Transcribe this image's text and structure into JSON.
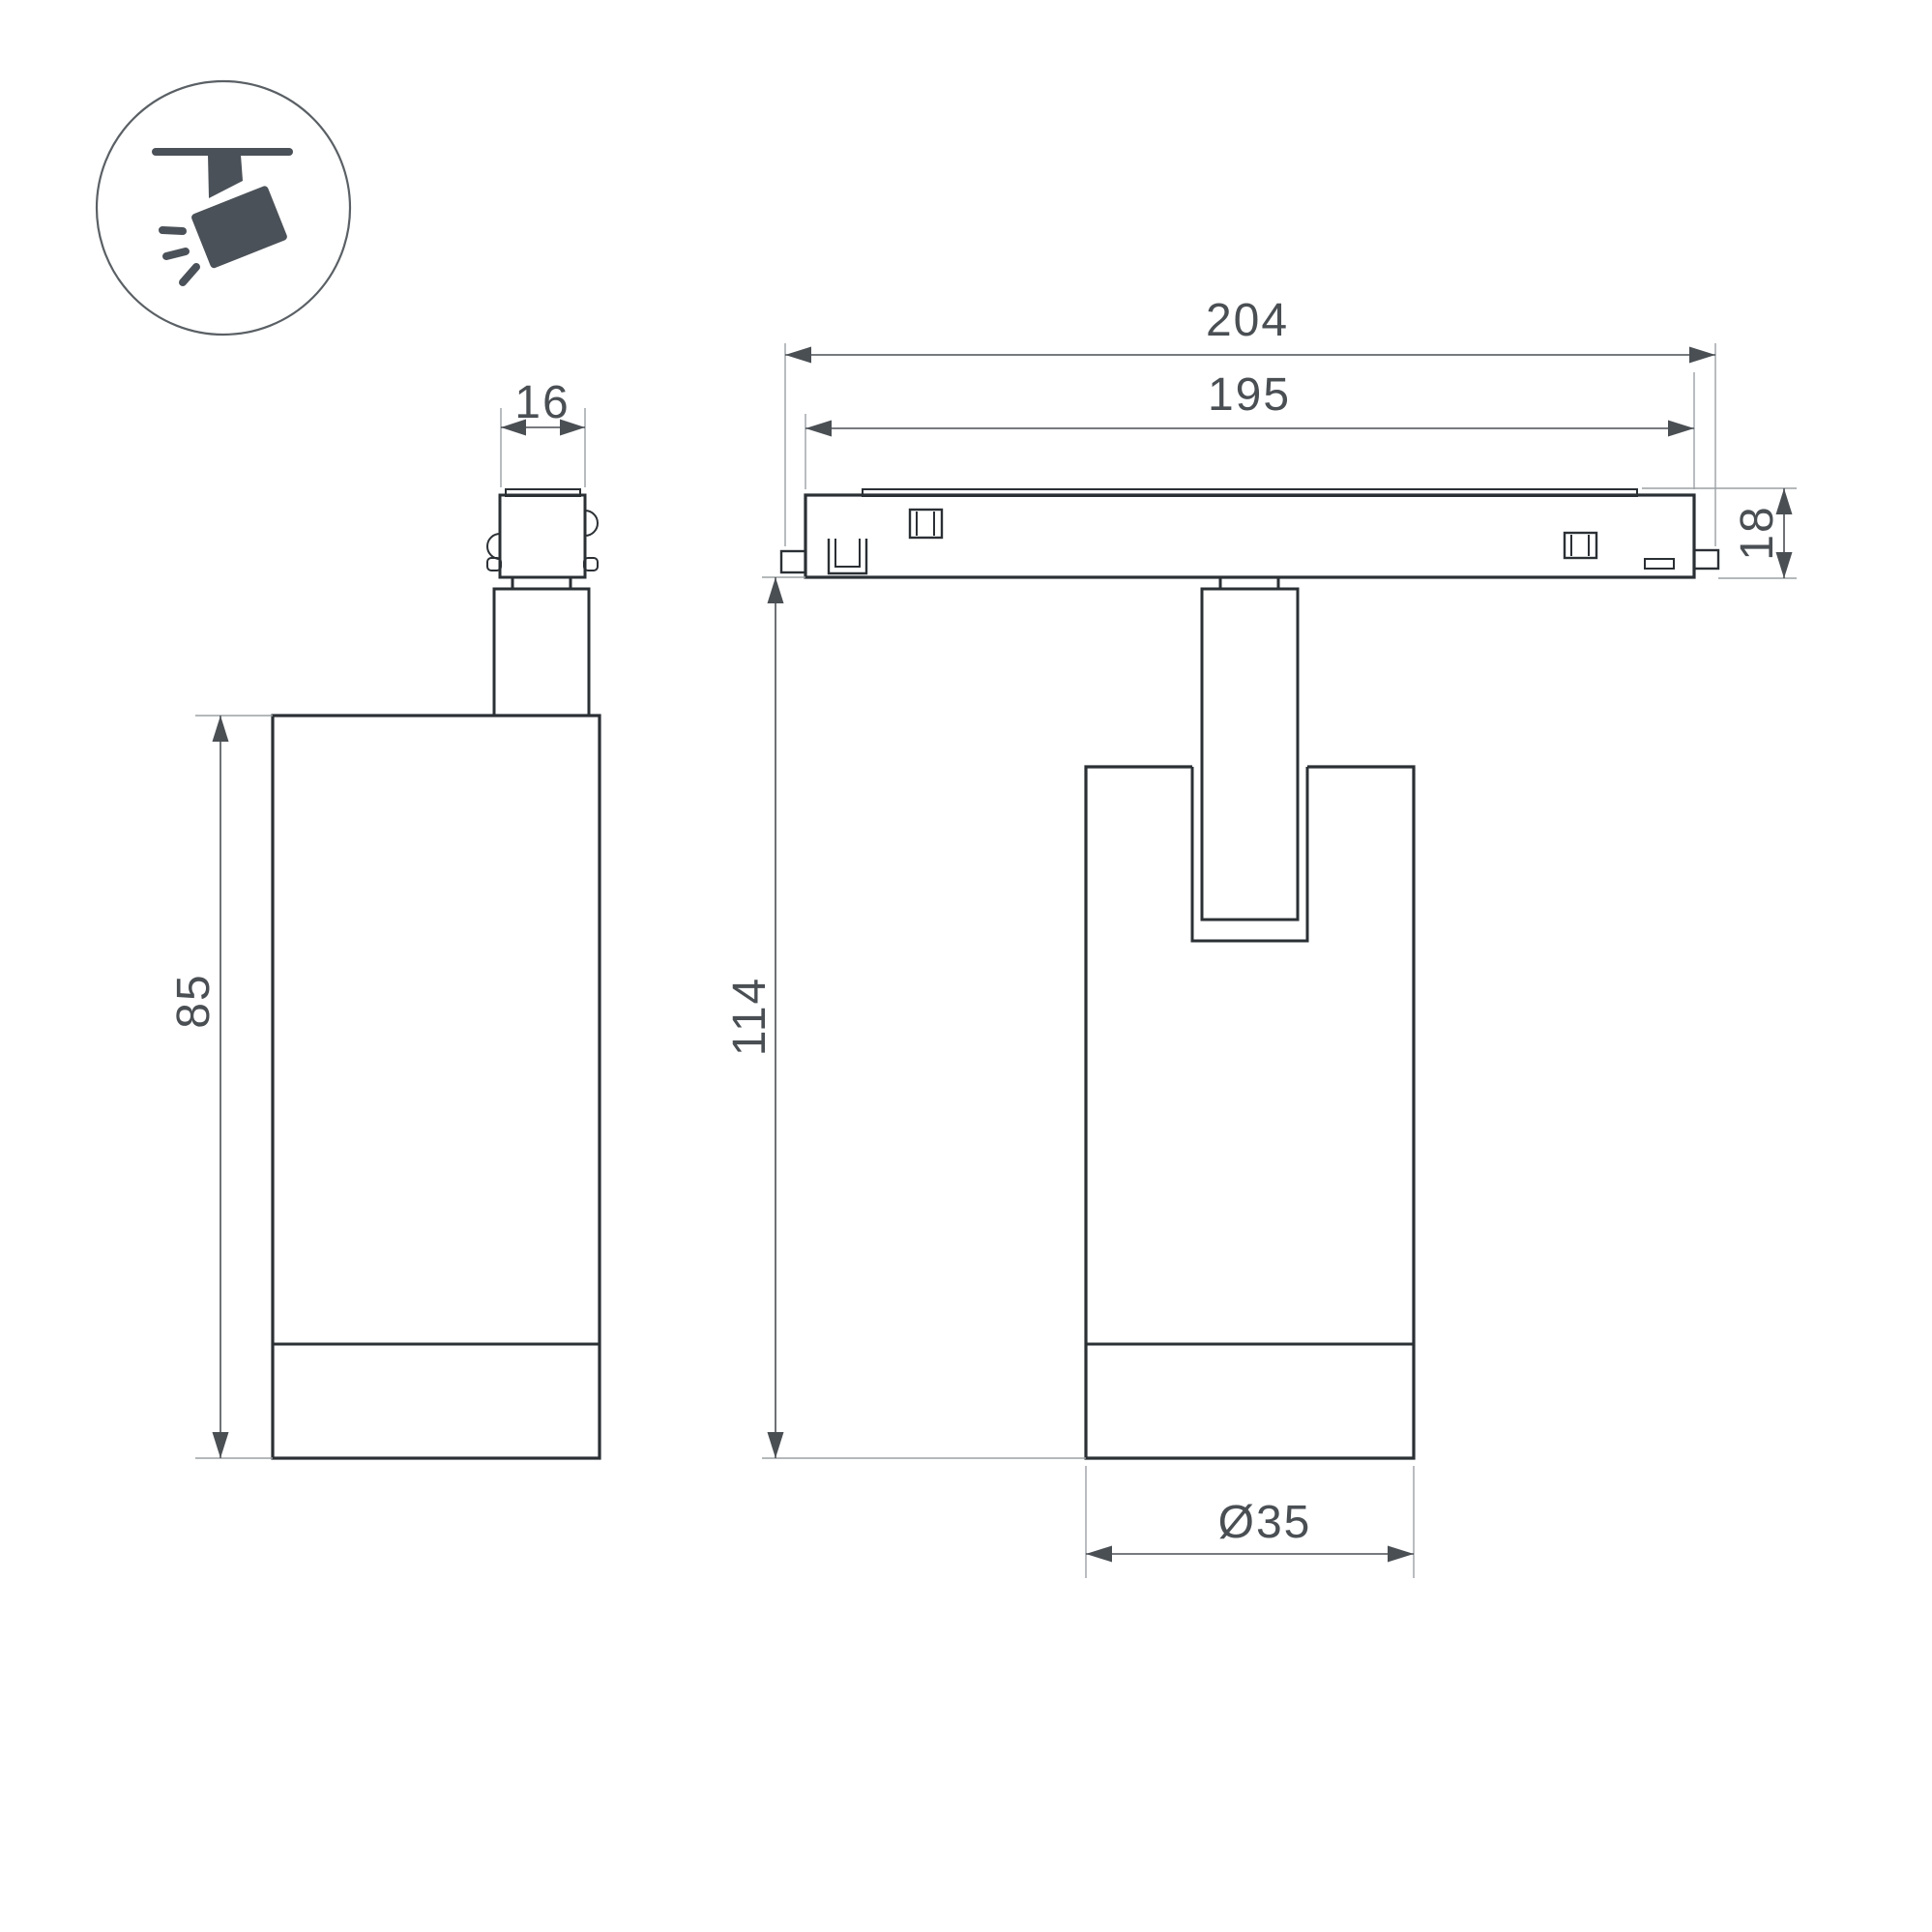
{
  "drawing_type": "luminaire dimension drawing, two orthographic views",
  "colors": {
    "background": "#ffffff",
    "outline": "#2b3035",
    "dimension": "#4a4f54",
    "extension_line": "#9ba0a4",
    "icon_fill": "#4b5158",
    "icon_circle_stroke": "#5a6065"
  },
  "icon": {
    "label": "ceiling-track spotlight pictogram"
  },
  "dimensions": {
    "adapter_width": "16",
    "body_height": "85",
    "track_overall_length": "204",
    "track_body_length": "195",
    "track_height": "18",
    "total_height": "114",
    "body_diameter": "Ø35"
  }
}
